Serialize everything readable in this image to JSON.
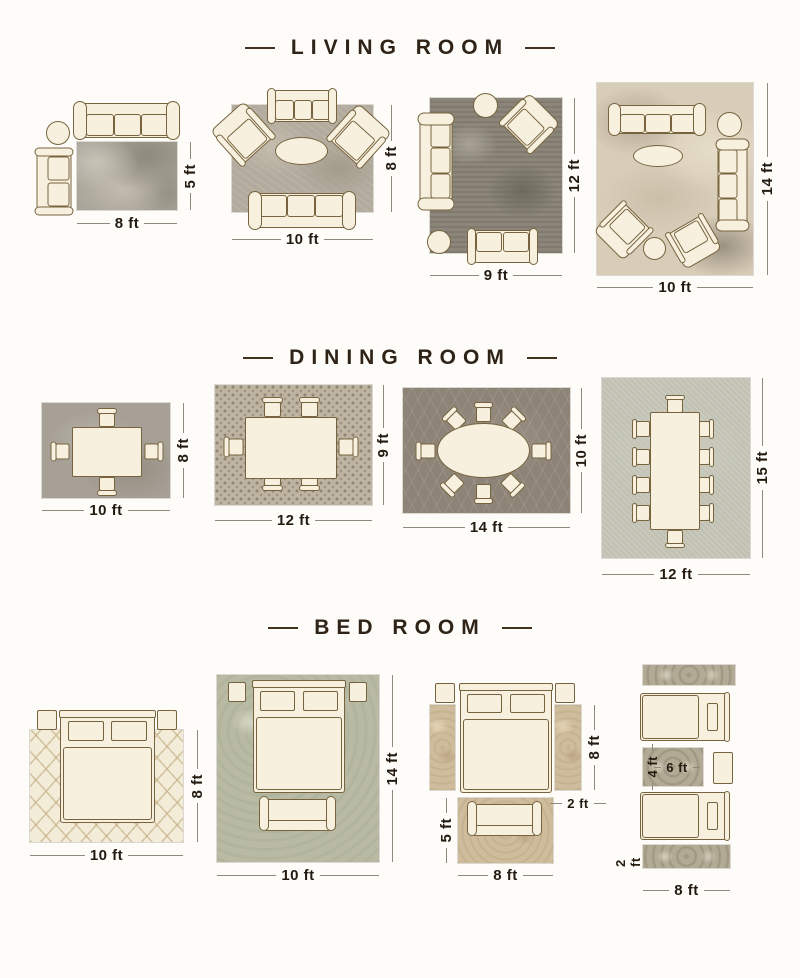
{
  "palette": {
    "background": "#fdfcf9",
    "title_color": "#2e2316",
    "label_color": "#241b10",
    "furniture_fill": "#f7f0df",
    "furniture_outline": "#77643f"
  },
  "sections": [
    {
      "title": "LIVING ROOM",
      "layouts": [
        {
          "w": "8 ft",
          "h": "5 ft"
        },
        {
          "w": "10 ft",
          "h": "8 ft"
        },
        {
          "w": "9 ft",
          "h": "12 ft"
        },
        {
          "w": "10 ft",
          "h": "14 ft"
        }
      ]
    },
    {
      "title": "DINING ROOM",
      "layouts": [
        {
          "w": "10 ft",
          "h": "8 ft"
        },
        {
          "w": "12 ft",
          "h": "9 ft"
        },
        {
          "w": "14 ft",
          "h": "10 ft"
        },
        {
          "w": "12 ft",
          "h": "15 ft"
        }
      ]
    },
    {
      "title": "BED ROOM",
      "layouts": [
        {
          "w": "10 ft",
          "h": "8 ft"
        },
        {
          "w": "10 ft",
          "h": "14 ft"
        },
        {
          "w": "8 ft",
          "h": "8 ft",
          "runner_w": "2 ft",
          "front_h": "5 ft"
        },
        {
          "w": "8 ft",
          "mid_h": "4 ft",
          "mid_w": "6 ft",
          "runner_h": "2 ft"
        }
      ]
    }
  ]
}
